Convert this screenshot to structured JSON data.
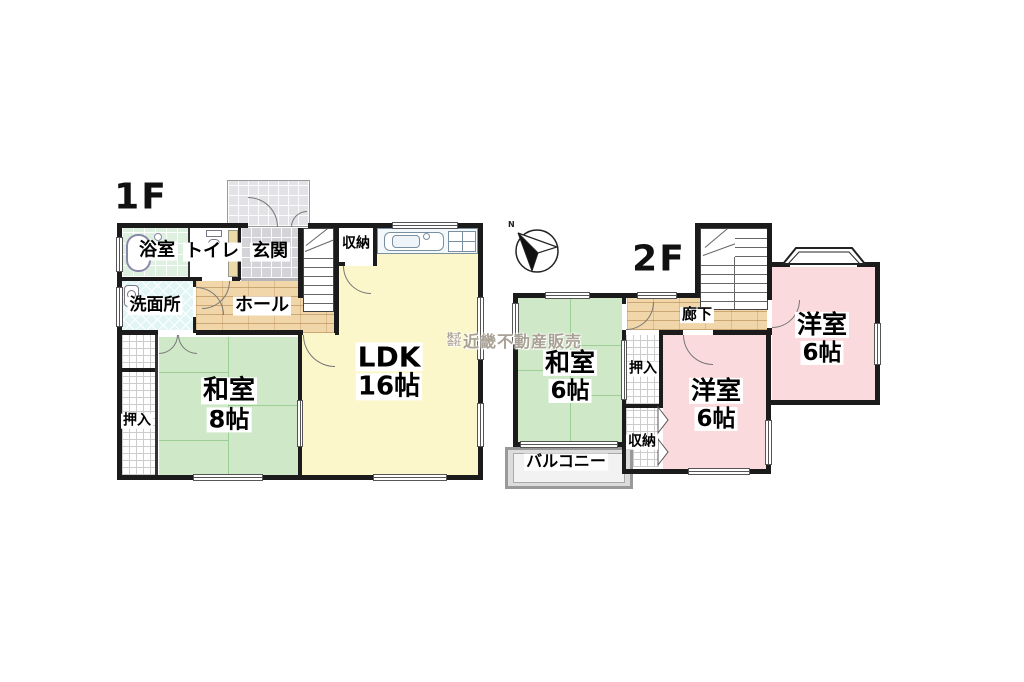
{
  "floor1": {
    "label": "1F",
    "bath": "浴室",
    "toilet": "トイレ",
    "entrance": "玄関",
    "storage": "収納",
    "washroom": "洗面所",
    "hall": "ホール",
    "ldk": "LDK",
    "ldk_size": "16帖",
    "japanese_room": "和室",
    "japanese_room_size": "8帖",
    "closet": "押入"
  },
  "floor2": {
    "label": "2F",
    "corridor": "廊下",
    "japanese_room": "和室",
    "japanese_room_size": "6帖",
    "closet": "押入",
    "storage": "収納",
    "balcony": "バルコニー",
    "western_room_a": "洋室",
    "western_room_a_size": "6帖",
    "western_room_b": "洋室",
    "western_room_b_size": "6帖"
  },
  "compass": {
    "north_label": "N"
  },
  "watermark": {
    "prefix_top": "株式",
    "prefix_bottom": "会社",
    "company": "近畿不動産販売"
  },
  "colors": {
    "wall": "#1b1b1b",
    "tatami_green": "#cfe9c8",
    "ldk_yellow": "#fbf7cb",
    "western_pink": "#fadadc",
    "wood_tan": "#f1d6a9",
    "entrance_tile": "#d4d4d8",
    "bath_green": "#def0df",
    "washroom_cyan": "#e2f5f5"
  }
}
